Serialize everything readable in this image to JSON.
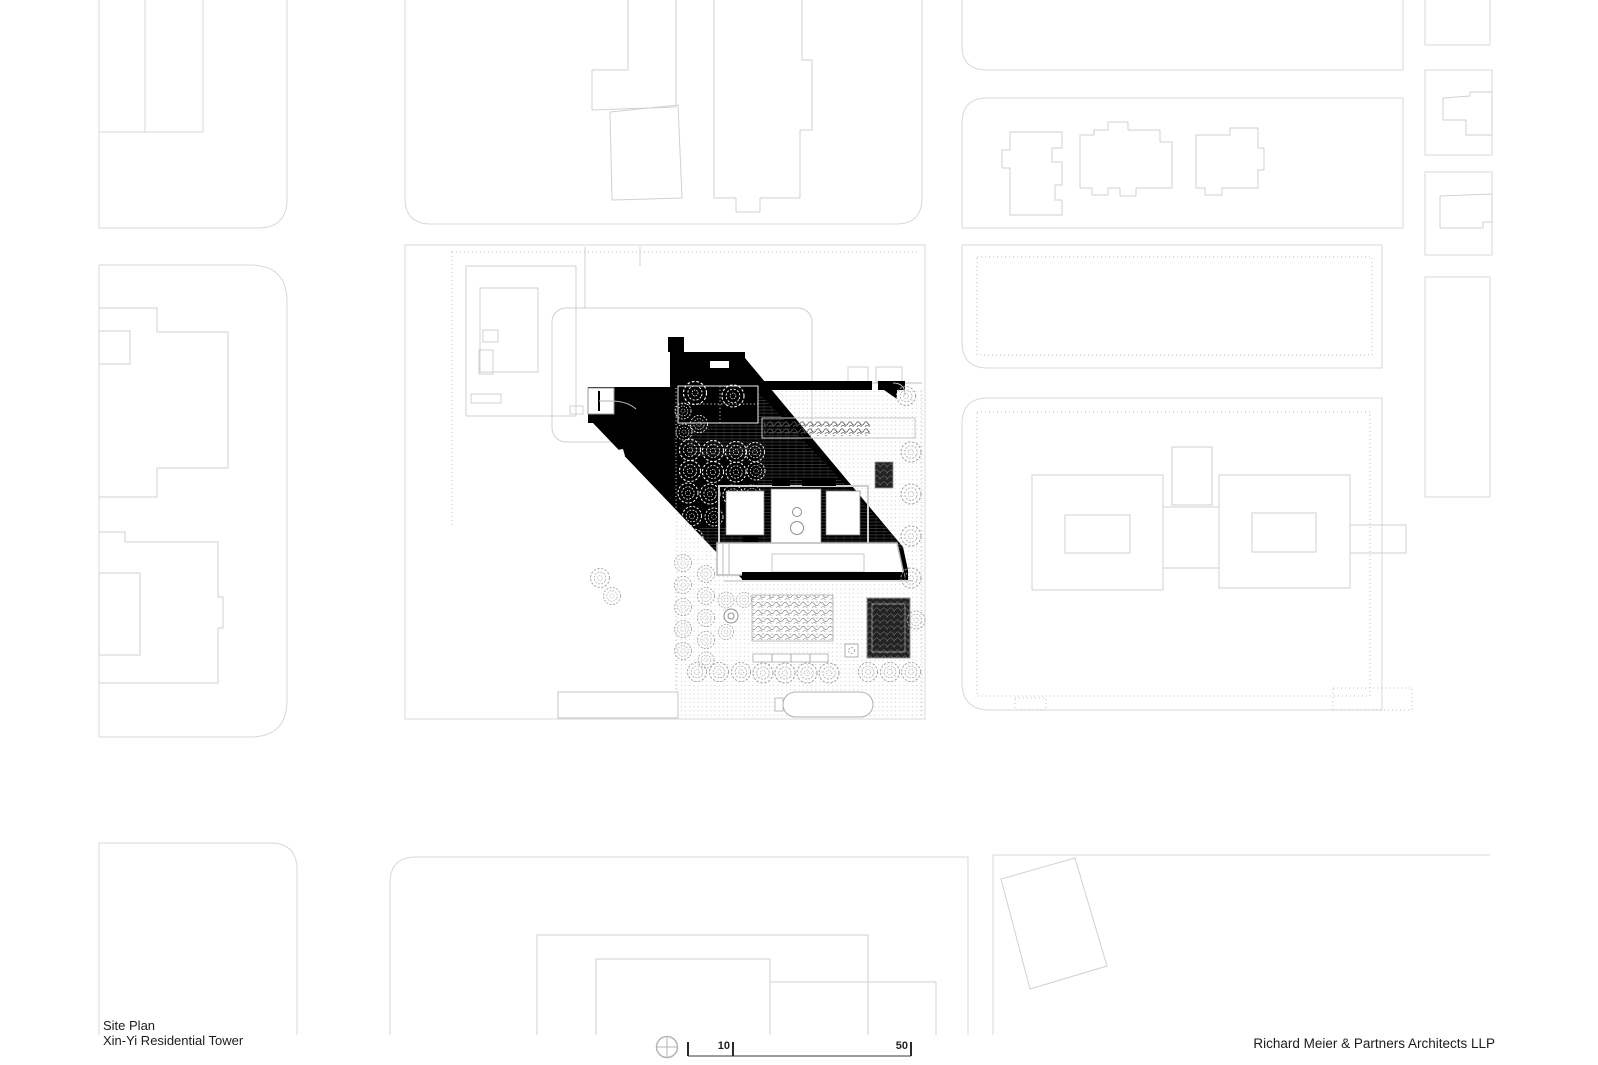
{
  "title_block": {
    "drawing_title": "Site Plan",
    "project_name": "Xin-Yi Residential Tower"
  },
  "firm": {
    "name": "Richard Meier & Partners Architects LLP"
  },
  "scale_bar": {
    "labels": [
      {
        "value": "10"
      },
      {
        "value": "50"
      }
    ],
    "north_icon": "north-symbol"
  },
  "drawing": {
    "type": "architectural-site-plan",
    "ink_color": "#000000",
    "context_line_color": "#d9d9d9",
    "background": "#ffffff"
  }
}
